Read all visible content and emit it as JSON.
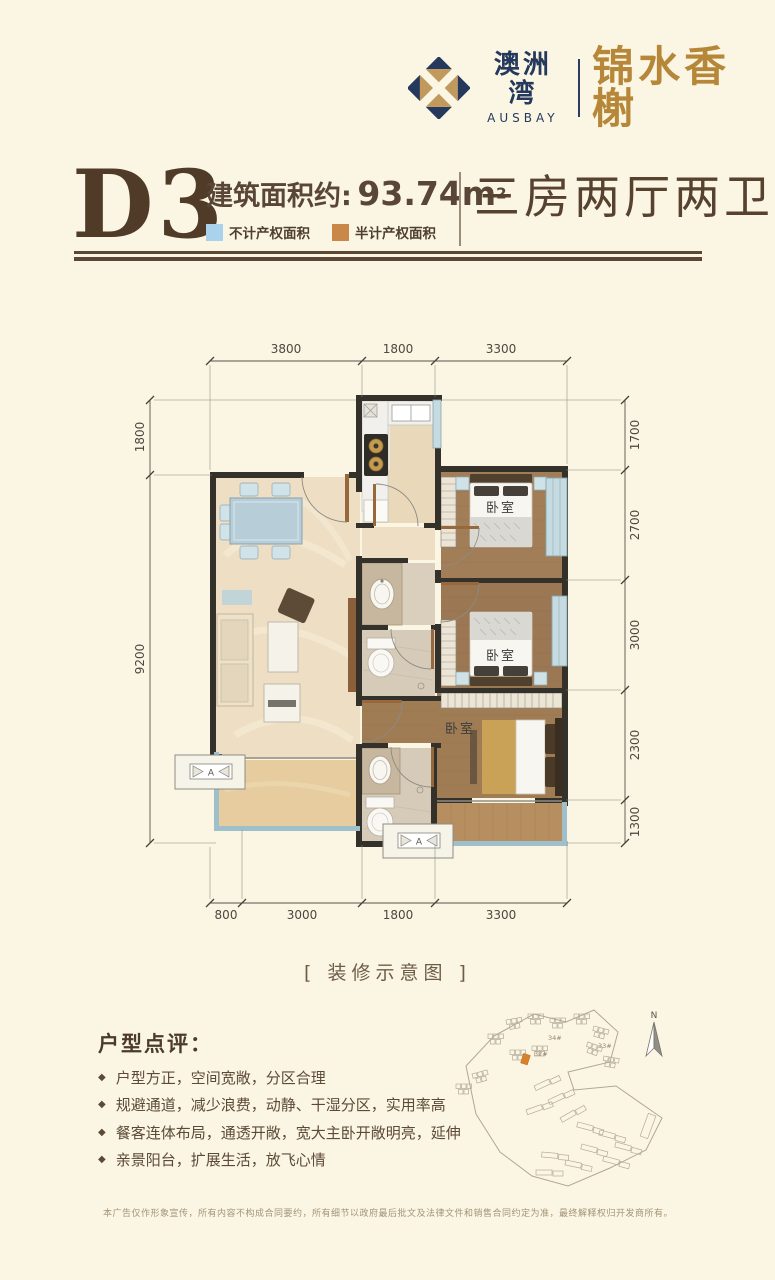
{
  "logo": {
    "brand_cn": "澳洲湾",
    "brand_en": "AUSBAY",
    "project_name": "锦水香榭",
    "navy": "#24395c",
    "gold": "#c2995c"
  },
  "header": {
    "unit_code": "D3",
    "area_label": "建筑面积约:",
    "area_value": "93.74m",
    "area_exponent": "2",
    "legend": [
      {
        "label": "不计产权面积",
        "color": "#a9d3ec"
      },
      {
        "label": "半计产权面积",
        "color": "#c9884a"
      }
    ],
    "layout_type": "三房两厅两卫"
  },
  "floorplan": {
    "caption": "[ 装修示意图 ]",
    "dims_top": [
      "3800",
      "1800",
      "3300"
    ],
    "dims_left": [
      "1800",
      "9200"
    ],
    "dims_right": [
      "1700",
      "2700",
      "3000",
      "2300",
      "1300"
    ],
    "dims_bottom": [
      "800",
      "3000",
      "1800",
      "3300"
    ],
    "rooms": {
      "bedroom": "卧室"
    },
    "ac_symbol": "A"
  },
  "review": {
    "heading": "户型点评：",
    "bullets": [
      "户型方正，空间宽敞，分区合理",
      "规避通道，减少浪费，动静、干湿分区，实用率高",
      "餐客连体布局，通透开敞，宽大主卧开敞明亮，延伸",
      "亲景阳台，扩展生活，放飞心情"
    ]
  },
  "sitemap": {
    "north_label": "N",
    "building_labels": [
      "34#",
      "32#",
      "33#"
    ],
    "highlight_color": "#d9822d"
  },
  "disclaimer": "本广告仅作形象宣传，所有内容不构成合同要约，所有细节以政府最后批文及法律文件和销售合同约定为准，最终解释权归开发商所有。"
}
